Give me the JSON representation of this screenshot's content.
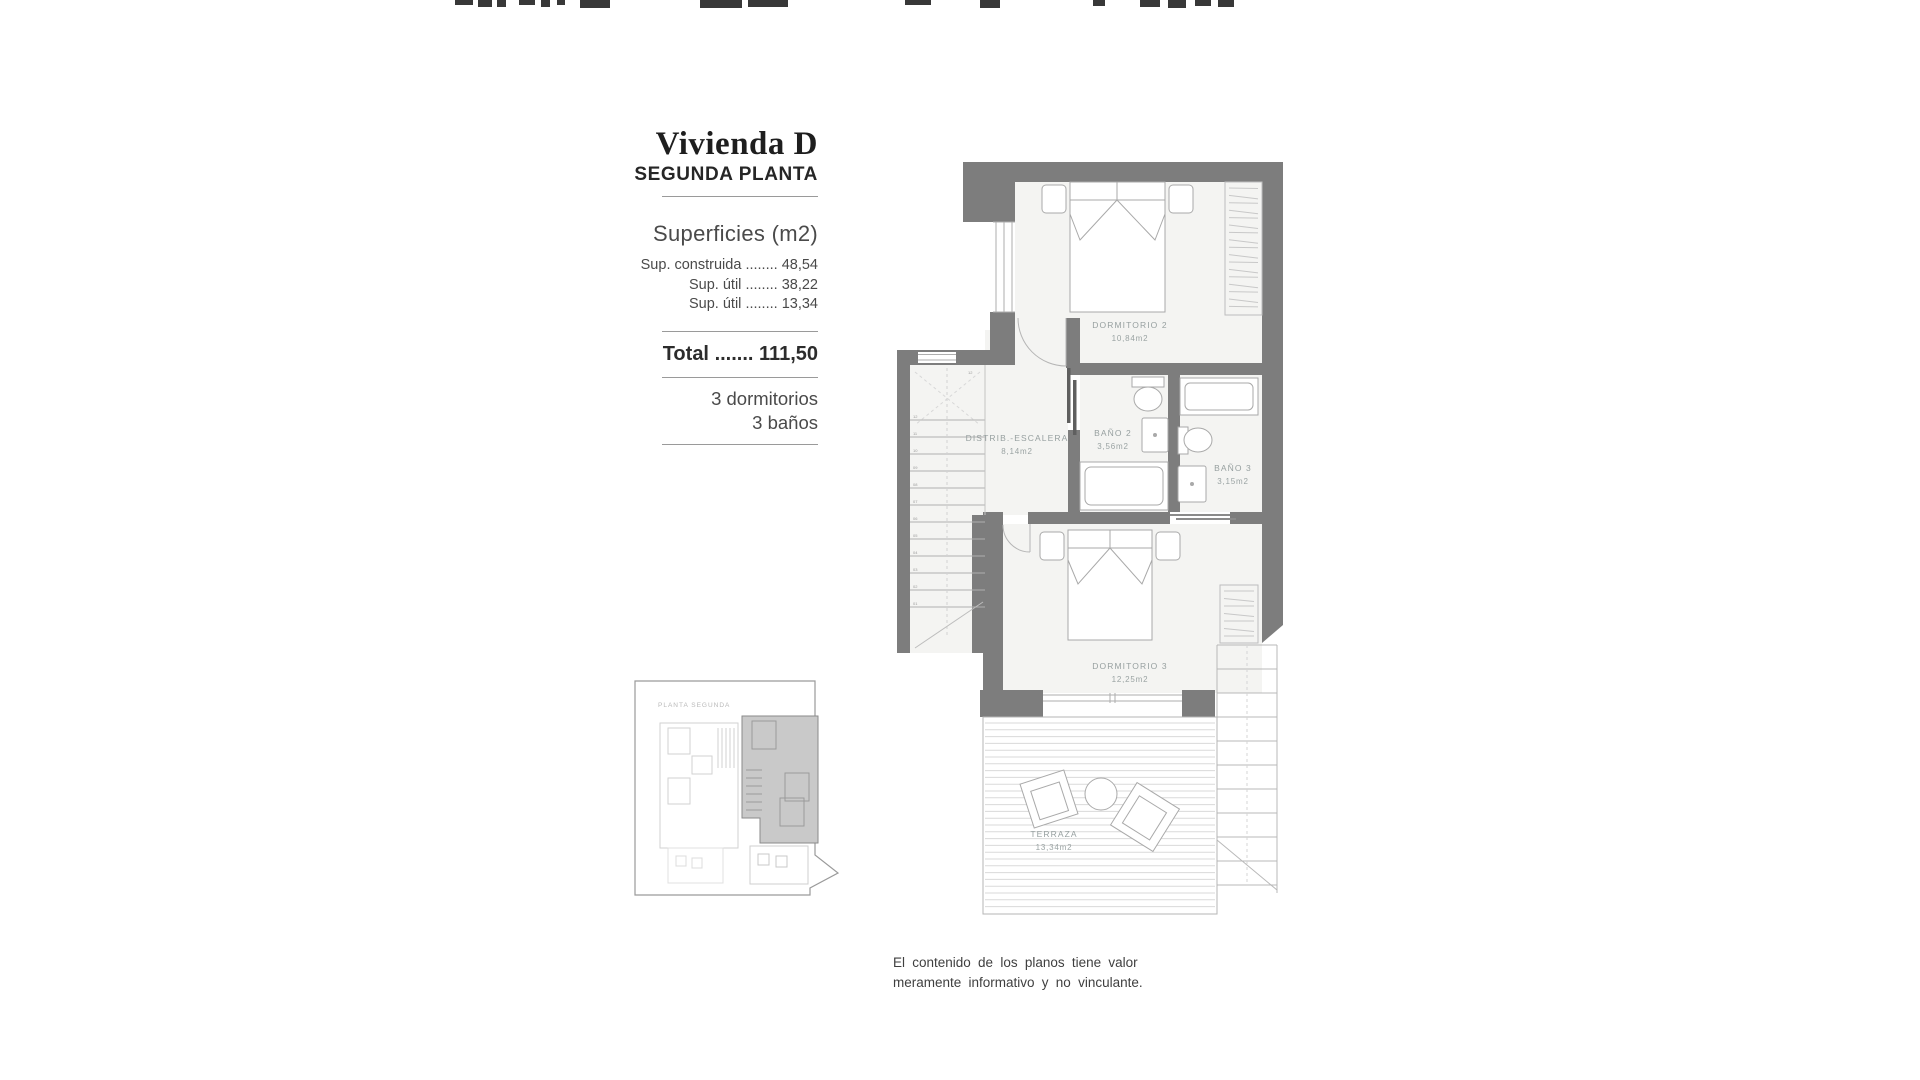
{
  "info_panel": {
    "title": "Vivienda D",
    "subtitle": "SEGUNDA PLANTA",
    "section_heading": "Superficies (m2)",
    "surface_rows": [
      {
        "label": "Sup. construida",
        "dots": "........",
        "value": "48,54"
      },
      {
        "label": "Sup. útil",
        "dots": "........",
        "value": "38,22"
      },
      {
        "label": "Sup. útil",
        "dots": "........",
        "value": "13,34"
      }
    ],
    "total": {
      "label": "Total",
      "dots": ".......",
      "value": "111,50"
    },
    "features": [
      "3 dormitorios",
      "3 baños"
    ]
  },
  "floor_plan": {
    "rooms": [
      {
        "name": "DORMITORIO 2",
        "area": "10,84m2"
      },
      {
        "name": "DISTRIB.-ESCALERA",
        "area": "8,14m2"
      },
      {
        "name": "BAÑO 2",
        "area": "3,56m2"
      },
      {
        "name": "BAÑO 3",
        "area": "3,15m2"
      },
      {
        "name": "DORMITORIO 3",
        "area": "12,25m2"
      },
      {
        "name": "TERRAZA",
        "area": "13,34m2"
      }
    ],
    "stair_top_label": "12",
    "stair_step_numbers": [
      "12",
      "11",
      "10",
      "09",
      "08",
      "07",
      "06",
      "05",
      "04",
      "03",
      "02",
      "01"
    ],
    "colors": {
      "wall": "#7d7d7d",
      "room_fill": "#f4f4f2",
      "furniture_line": "#a9a9a9",
      "label_text": "#97a0a0"
    }
  },
  "key_plan": {
    "label": "PLANTA SEGUNDA"
  },
  "disclaimer": {
    "line1": "El contenido de los planos tiene valor",
    "line2": "meramente informativo y no vinculante."
  }
}
